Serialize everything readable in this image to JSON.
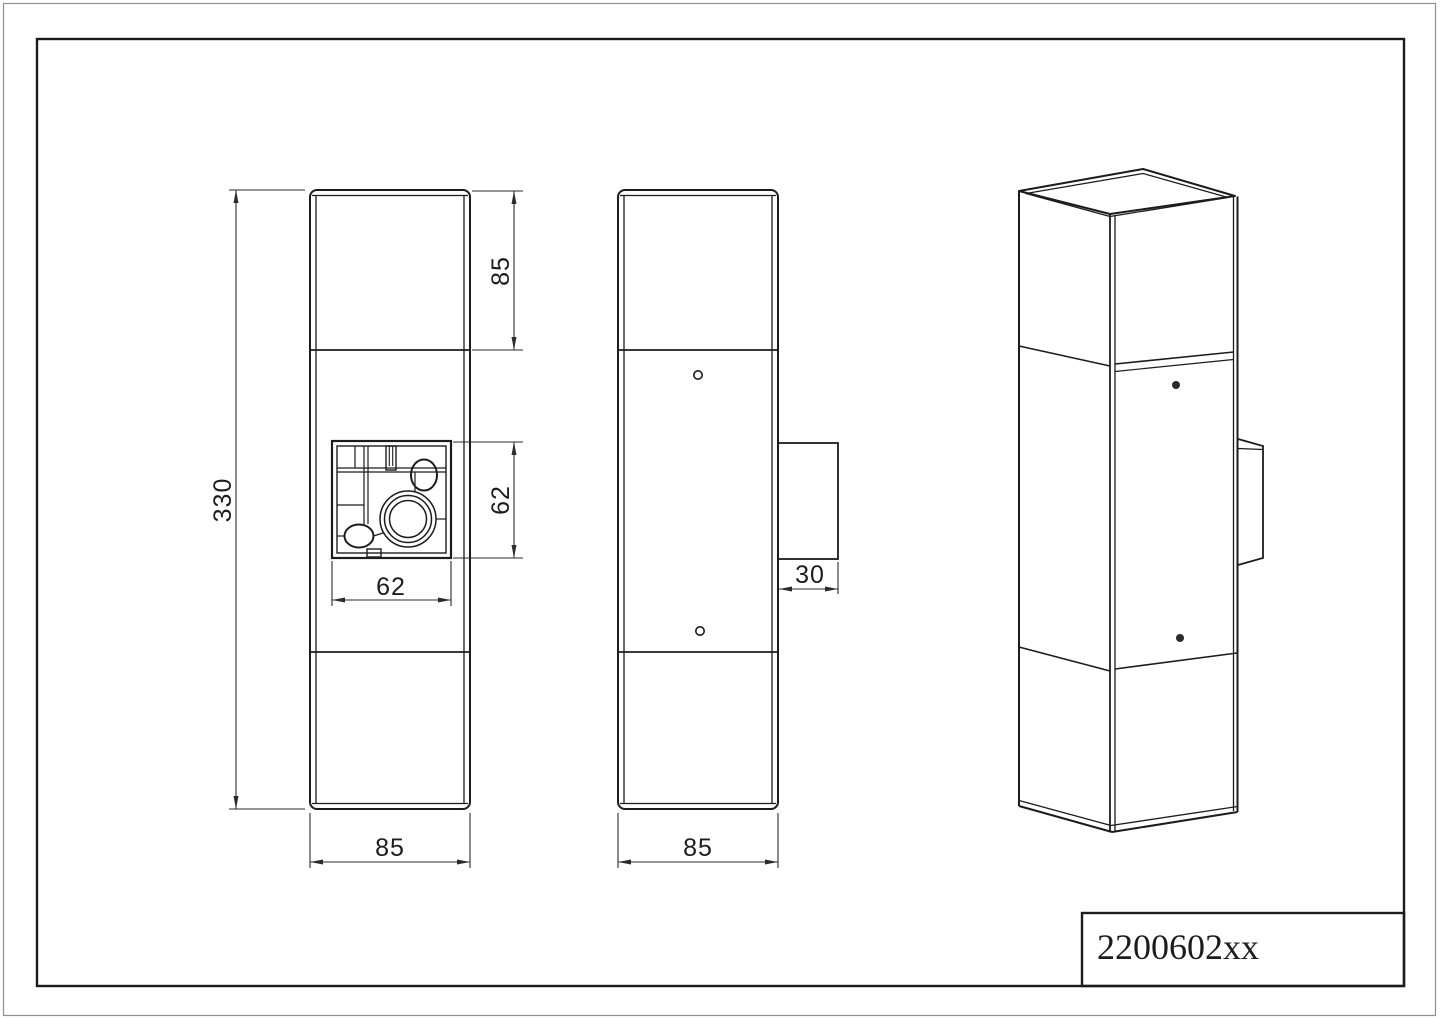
{
  "title_block": {
    "part_number": "2200602xx"
  },
  "dimensions": {
    "overall_height": "330",
    "top_section_height": "85",
    "cutout_height": "62",
    "cutout_width": "62",
    "front_width": "85",
    "side_depth": "85",
    "bracket_depth": "30"
  },
  "colors": {
    "line": "#1c1c1c",
    "dim": "#2b2b2b",
    "outer_frame": "#8f8f8f",
    "paper": "#ffffff"
  }
}
